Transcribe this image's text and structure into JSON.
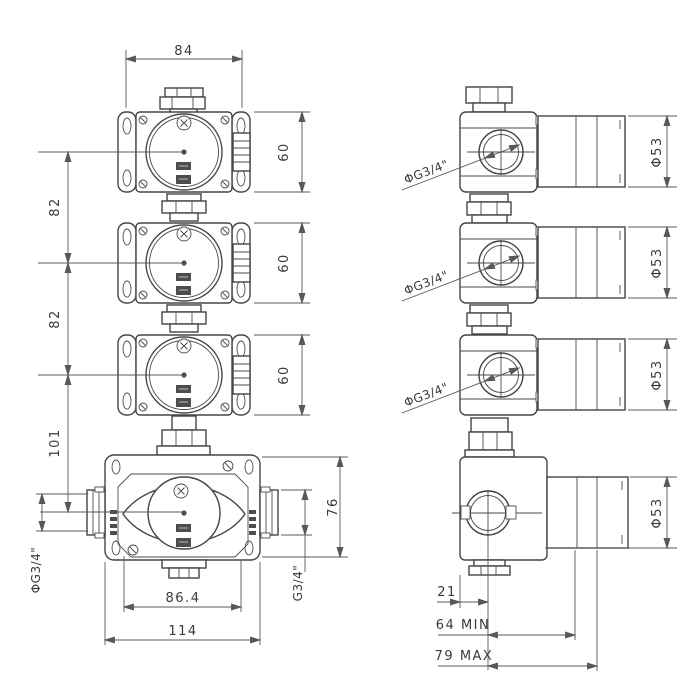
{
  "drawing_type": "technical-dimension-drawing",
  "colors": {
    "background": "#ffffff",
    "object_line": "#454545",
    "dimension_line": "#585858",
    "text": "#3a3a3a"
  },
  "front_view": {
    "width": "84",
    "unit_heights": [
      "60",
      "60",
      "60"
    ],
    "spacings": [
      "82",
      "82"
    ],
    "base_offset": "101",
    "base_height": "76",
    "port_diameter": "ΦG3/4\"",
    "outlet_thread": "G3/4\"",
    "hole_spacing": "86.4",
    "base_width": "114"
  },
  "side_view": {
    "port_threads": [
      "ΦG3/4\"",
      "ΦG3/4\"",
      "ΦG3/4\""
    ],
    "coil_diameters": [
      "Φ53",
      "Φ53",
      "Φ53",
      "Φ53"
    ],
    "center_offset": "21",
    "length_min": "64 MIN",
    "length_max": "79 MAX"
  }
}
